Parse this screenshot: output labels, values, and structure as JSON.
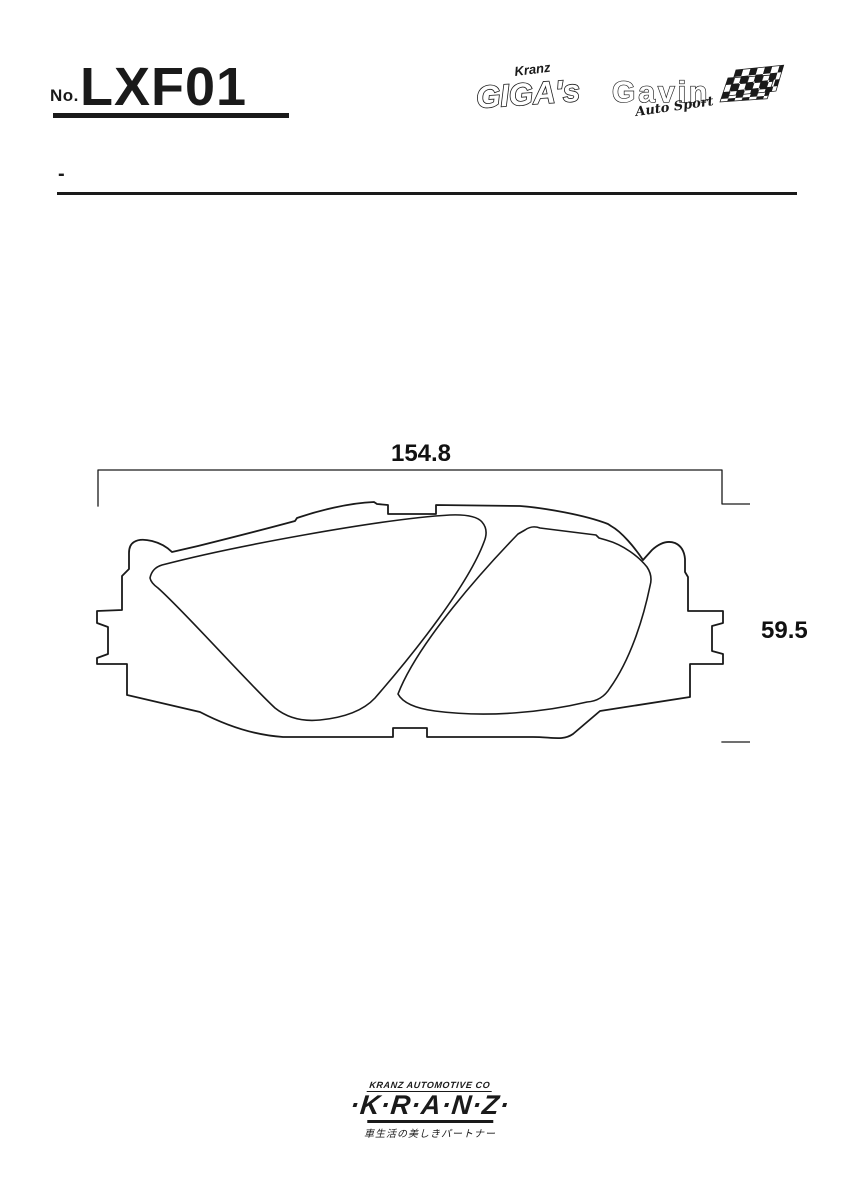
{
  "title": {
    "no_label": "No.",
    "part_number": "LXF01"
  },
  "subheader": {
    "dash": "-"
  },
  "logos": {
    "gigas_script": "Kranz",
    "gigas_main": "GIGA's",
    "gavin_main": "Gavin",
    "gavin_script": "Auto Sport"
  },
  "drawing": {
    "width_label": "154.8",
    "height_label": "59.5"
  },
  "footer": {
    "company_line": "KRANZ AUTOMOTIVE CO",
    "brand": "·K·R·A·N·Z·",
    "tagline_ja": "車生活の美しきパートナー"
  },
  "colors": {
    "ink": "#1a1a1a",
    "bg": "#ffffff"
  }
}
